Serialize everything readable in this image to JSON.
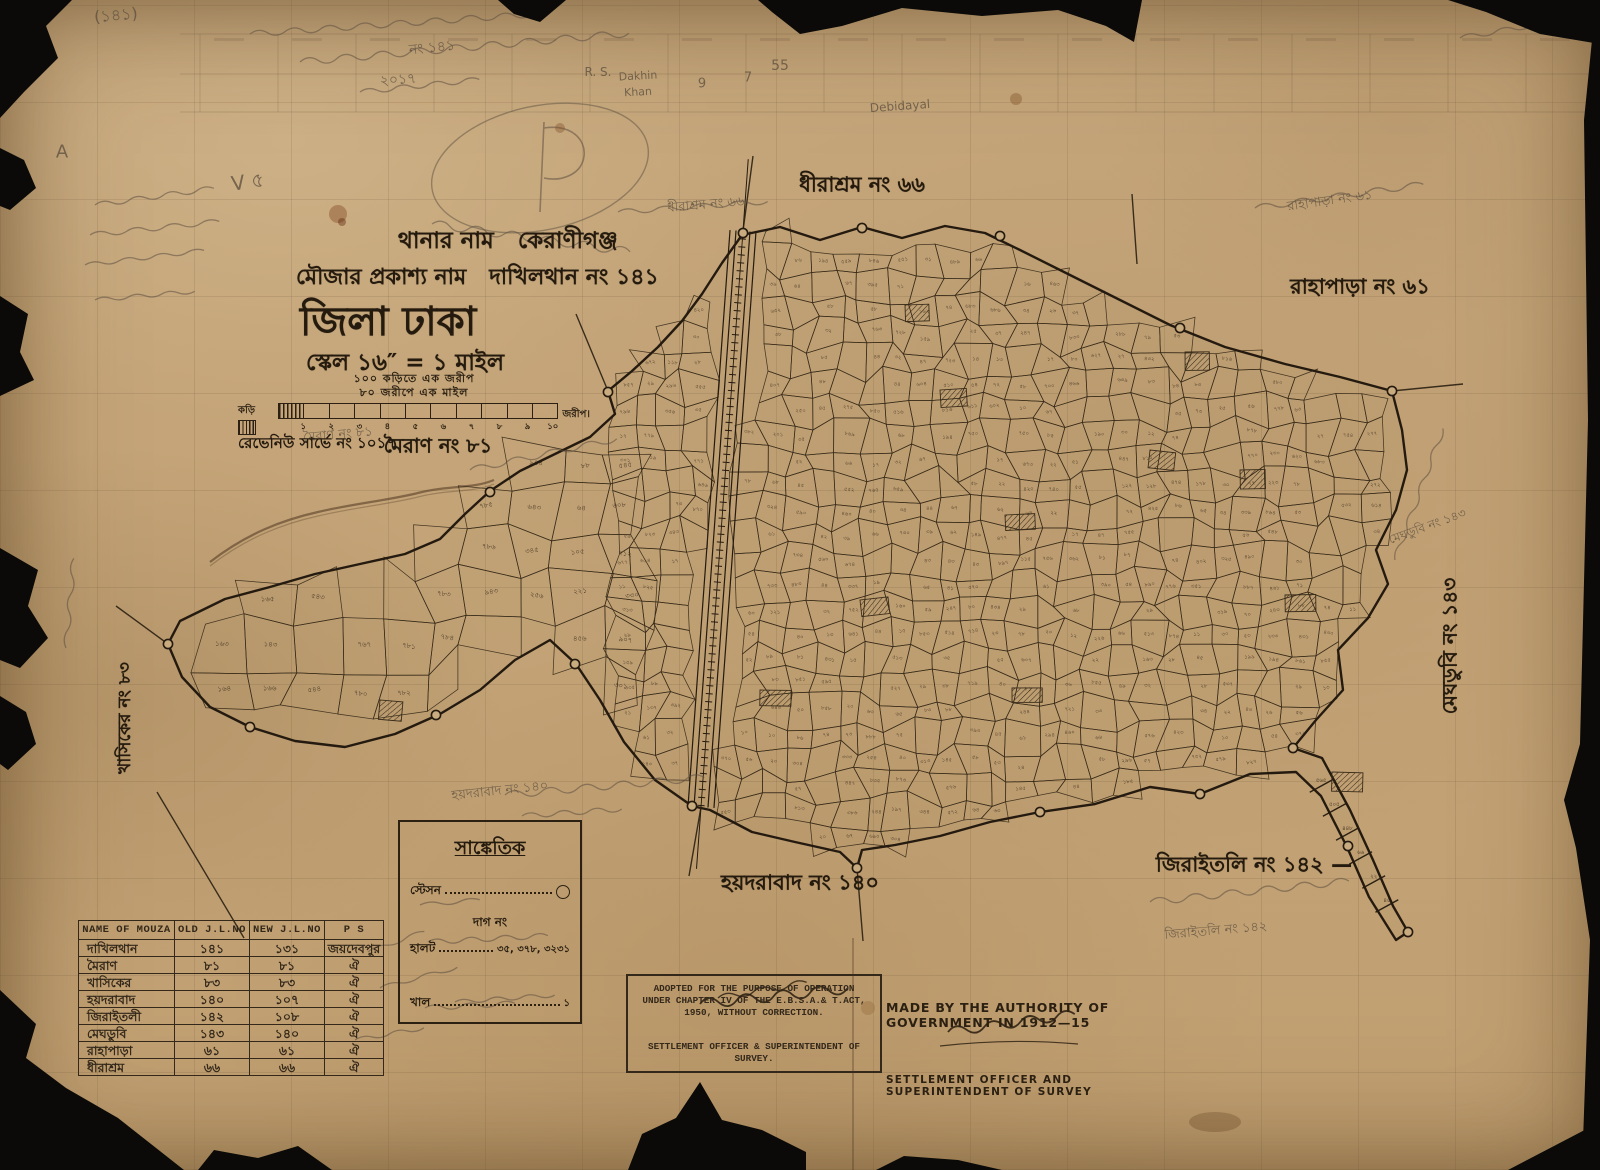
{
  "colors": {
    "paper": "#c6a77c",
    "ink": "#2b2012",
    "pencil": "#6e6051",
    "torn_edge": "#0b0a08",
    "table_ink": "#33281a"
  },
  "title_block": {
    "line1_label": "থানার নাম",
    "line1_value": "কেরাণীগঞ্জ",
    "line2_label": "মৌজার প্রকাশ্য নাম",
    "line2_value": "দাখিলথান নং ১৪১",
    "district": "জিলা ঢাকা",
    "scale_line": "স্কেল ১৬″ = ১ মাইল"
  },
  "scale_bar": {
    "caption1": "১০০ কড়িতে এক জরীপ",
    "caption2": "৮০ জরীপে এক মাইল",
    "left_label": "কড়ি",
    "right_label": "জরীপ।",
    "ticks": [
      "১",
      "২",
      "৩",
      "৪",
      "৫",
      "৬",
      "৭",
      "৮",
      "৯",
      "১০"
    ],
    "revenue": "রেভেনিউ সার্ভে নং ১০১৭"
  },
  "legend": {
    "title": "সাঙ্কেতিক",
    "station_label": "স্টেসন",
    "dag_label": "দাগ নং",
    "halot_label": "হালট",
    "halot_value": "৩৫, ৩৭৮, ৩২৩১",
    "khal_label": "খাল",
    "khal_value": "১"
  },
  "table": {
    "headers": [
      "NAME OF MOUZA",
      "OLD J.L.NO",
      "NEW J.L.NO",
      "P S"
    ],
    "rows": [
      [
        "দাখিলথান",
        "১৪১",
        "১৩১",
        "জয়দেবপুর"
      ],
      [
        "মৈরাণ",
        "৮১",
        "৮১",
        "ঐ"
      ],
      [
        "খাসিকের",
        "৮৩",
        "৮৩",
        "ঐ"
      ],
      [
        "হয়দরাবাদ",
        "১৪০",
        "১০৭",
        "ঐ"
      ],
      [
        "জিরাইতলী",
        "১৪২",
        "১০৮",
        "ঐ"
      ],
      [
        "মেঘডুবি",
        "১৪৩",
        "১৪০",
        "ঐ"
      ],
      [
        "রাহাপাড়া",
        "৬১",
        "৬১",
        "ঐ"
      ],
      [
        "ধীরাশ্রম",
        "৬৬",
        "৬৬",
        "ঐ"
      ]
    ]
  },
  "stamp": {
    "line1": "ADOPTED FOR THE PURPOSE OF OPERATION",
    "line2": "UNDER CHAPTER IV OF THE E.B.S.A.& T.ACT,",
    "line3": "1950, WITHOUT CORRECTION.",
    "signature": "K. A. Khan",
    "line4": "SETTLEMENT OFFICER & SUPERINTENDENT OF",
    "line5": "SURVEY."
  },
  "authority": {
    "line1": "MADE BY THE AUTHORITY OF GOVERNMENT IN 1912—15",
    "signature": "F. D. Ascoli",
    "line2": "SETTLEMENT OFFICER AND SUPERINTENDENT OF SURVEY"
  },
  "mouza_labels": [
    {
      "text": "ধীরাশ্রম নং ৬৬",
      "x": 862,
      "y": 186,
      "size": 21,
      "rot": 0
    },
    {
      "text": "রাহাপাড়া নং ৬১",
      "x": 1360,
      "y": 288,
      "size": 21,
      "rot": 0
    },
    {
      "text": "মেঘডুবি নং ১৪৩",
      "x": 1452,
      "y": 646,
      "size": 20,
      "rot": -90
    },
    {
      "text": "জিরাইতলি নং ১৪২ —",
      "x": 1254,
      "y": 866,
      "size": 21,
      "rot": 0
    },
    {
      "text": "হয়দরাবাদ নং ১৪০",
      "x": 800,
      "y": 884,
      "size": 21,
      "rot": 0
    },
    {
      "text": "মৈরাণ নং ৮১",
      "x": 438,
      "y": 448,
      "size": 20,
      "rot": 0
    },
    {
      "text": "খাসিকের নং ৮৩",
      "x": 126,
      "y": 718,
      "size": 17,
      "rot": -90
    }
  ],
  "pencil_notes": [
    {
      "text": "(১৪১)",
      "x": 116,
      "y": 16,
      "size": 16,
      "rot": -5
    },
    {
      "text": "নং ১৪১",
      "x": 432,
      "y": 48,
      "size": 14,
      "rot": -6
    },
    {
      "text": "২০১৭",
      "x": 398,
      "y": 80,
      "size": 14,
      "rot": -4
    },
    {
      "text": "A",
      "x": 62,
      "y": 152,
      "size": 18,
      "rot": 0
    },
    {
      "text": "V ৫",
      "x": 248,
      "y": 184,
      "size": 20,
      "rot": -8
    },
    {
      "text": "R. S.",
      "x": 598,
      "y": 72,
      "size": 12,
      "rot": 0
    },
    {
      "text": "Dakhin",
      "x": 638,
      "y": 76,
      "size": 11,
      "rot": -3
    },
    {
      "text": "Khan",
      "x": 638,
      "y": 92,
      "size": 11,
      "rot": -3
    },
    {
      "text": "9",
      "x": 702,
      "y": 84,
      "size": 13,
      "rot": 0
    },
    {
      "text": "7",
      "x": 748,
      "y": 78,
      "size": 13,
      "rot": 0
    },
    {
      "text": "55",
      "x": 780,
      "y": 66,
      "size": 14,
      "rot": 0
    },
    {
      "text": "Debidayal",
      "x": 900,
      "y": 106,
      "size": 12,
      "rot": -4
    },
    {
      "text": "ধীরাশ্রম নং ৬৬",
      "x": 706,
      "y": 206,
      "size": 13,
      "rot": -5
    },
    {
      "text": "রাহাপাড়া নং ৬১",
      "x": 1330,
      "y": 202,
      "size": 13,
      "rot": -8
    },
    {
      "text": "মেঘডুবি নং ১৪৩",
      "x": 1428,
      "y": 528,
      "size": 12,
      "rot": -20
    },
    {
      "text": "মৈরাণ নং ৮১",
      "x": 338,
      "y": 436,
      "size": 13,
      "rot": -5
    },
    {
      "text": "হয়দরাবাদ নং ১৪০",
      "x": 500,
      "y": 792,
      "size": 13,
      "rot": -6
    },
    {
      "text": "জিরাইতলি নং ১৪২",
      "x": 1216,
      "y": 932,
      "size": 13,
      "rot": -5
    }
  ],
  "plot_number_samples": [
    "১৬৩",
    "১৬৪",
    "১৬৫",
    "১৪৩",
    "১৬৬",
    "৫৪৩",
    "৫৪৪",
    "৭৬৭",
    "৭৮০",
    "৭৮১",
    "৭৮২",
    "৭৮৩",
    "৭৮৪",
    "৭৮৫",
    "৭৮৬",
    "৯৪৩",
    "৯৪৪",
    "৬৪৩",
    "৩৪৫",
    "২৫৬",
    "৮৮",
    "৬৪",
    "১০৫",
    "২২১",
    "৪৫৬",
    "৫৪৫",
    "৬০৮",
    "৭১২",
    "৩৩০",
    "৯০৭"
  ],
  "map": {
    "boundary": [
      [
        742,
        235
      ],
      [
        780,
        227
      ],
      [
        820,
        240
      ],
      [
        862,
        227
      ],
      [
        902,
        238
      ],
      [
        945,
        226
      ],
      [
        985,
        233
      ],
      [
        1020,
        250
      ],
      [
        1070,
        275
      ],
      [
        1120,
        300
      ],
      [
        1170,
        325
      ],
      [
        1225,
        347
      ],
      [
        1285,
        364
      ],
      [
        1340,
        377
      ],
      [
        1392,
        391
      ],
      [
        1402,
        430
      ],
      [
        1407,
        470
      ],
      [
        1396,
        510
      ],
      [
        1376,
        550
      ],
      [
        1388,
        584
      ],
      [
        1368,
        618
      ],
      [
        1338,
        650
      ],
      [
        1343,
        690
      ],
      [
        1316,
        720
      ],
      [
        1293,
        748
      ],
      [
        1322,
        758
      ],
      [
        1350,
        810
      ],
      [
        1373,
        860
      ],
      [
        1393,
        906
      ],
      [
        1408,
        932
      ],
      [
        1396,
        940
      ],
      [
        1369,
        897
      ],
      [
        1347,
        847
      ],
      [
        1321,
        796
      ],
      [
        1296,
        772
      ],
      [
        1250,
        774
      ],
      [
        1200,
        794
      ],
      [
        1150,
        787
      ],
      [
        1095,
        804
      ],
      [
        1040,
        812
      ],
      [
        990,
        822
      ],
      [
        940,
        836
      ],
      [
        895,
        845
      ],
      [
        862,
        850
      ],
      [
        857,
        868
      ],
      [
        840,
        852
      ],
      [
        795,
        842
      ],
      [
        752,
        832
      ],
      [
        710,
        810
      ],
      [
        692,
        806
      ],
      [
        655,
        780
      ],
      [
        624,
        742
      ],
      [
        600,
        700
      ],
      [
        576,
        664
      ],
      [
        550,
        640
      ],
      [
        515,
        660
      ],
      [
        480,
        690
      ],
      [
        440,
        714
      ],
      [
        395,
        734
      ],
      [
        345,
        747
      ],
      [
        295,
        741
      ],
      [
        250,
        727
      ],
      [
        210,
        707
      ],
      [
        182,
        677
      ],
      [
        168,
        644
      ],
      [
        180,
        621
      ],
      [
        225,
        599
      ],
      [
        270,
        587
      ],
      [
        315,
        574
      ],
      [
        360,
        564
      ],
      [
        405,
        554
      ],
      [
        440,
        539
      ],
      [
        465,
        514
      ],
      [
        490,
        491
      ],
      [
        520,
        471
      ],
      [
        555,
        454
      ],
      [
        590,
        437
      ],
      [
        615,
        414
      ],
      [
        608,
        391
      ],
      [
        632,
        371
      ],
      [
        658,
        347
      ],
      [
        682,
        321
      ],
      [
        702,
        294
      ],
      [
        722,
        263
      ]
    ],
    "railway": {
      "x1": 743,
      "y1": 231,
      "x2": 701,
      "y2": 807
    },
    "stations": [
      [
        743,
        233
      ],
      [
        608,
        392
      ],
      [
        490,
        492
      ],
      [
        168,
        644
      ],
      [
        250,
        727
      ],
      [
        436,
        715
      ],
      [
        575,
        664
      ],
      [
        692,
        806
      ],
      [
        857,
        868
      ],
      [
        1040,
        812
      ],
      [
        1200,
        794
      ],
      [
        1293,
        748
      ],
      [
        1348,
        846
      ],
      [
        1408,
        932
      ],
      [
        1392,
        391
      ],
      [
        1180,
        328
      ],
      [
        1000,
        236
      ],
      [
        862,
        228
      ]
    ],
    "ties": [
      [
        [
          1132,
          194
        ],
        [
          1137,
          264
        ]
      ],
      [
        [
          608,
          391
        ],
        [
          576,
          314
        ]
      ],
      [
        [
          1392,
          391
        ],
        [
          1463,
          384
        ]
      ],
      [
        [
          157,
          792
        ],
        [
          244,
          938
        ]
      ],
      [
        [
          168,
          644
        ],
        [
          116,
          606
        ]
      ],
      [
        [
          857,
          868
        ],
        [
          863,
          941
        ]
      ],
      [
        [
          743,
          231
        ],
        [
          753,
          156
        ]
      ],
      [
        [
          701,
          807
        ],
        [
          689,
          876
        ]
      ]
    ],
    "river": "M210,562 C246,534 282,520 318,512 C356,503 392,500 422,492 C452,485 472,489 494,480",
    "hatches": [
      [
        940,
        390
      ],
      [
        1150,
        450
      ],
      [
        1285,
        595
      ],
      [
        1005,
        515
      ],
      [
        860,
        600
      ],
      [
        760,
        690
      ],
      [
        1012,
        688
      ],
      [
        1185,
        352
      ],
      [
        380,
        700
      ],
      [
        1332,
        772
      ],
      [
        905,
        305
      ],
      [
        1240,
        470
      ]
    ],
    "tail": {
      "from": [
        1308,
        762
      ],
      "to": [
        1400,
        930
      ],
      "rungs": 6,
      "halfw": 13
    },
    "meshes": [
      {
        "x0": 160,
        "y0": 440,
        "x1": 628,
        "y1": 756,
        "step": 44,
        "seed": 7,
        "labelProb": 0.85,
        "font": 7
      },
      {
        "x0": 612,
        "y0": 224,
        "x1": 1418,
        "y1": 868,
        "step": 25,
        "seed": 3,
        "labelProb": 0.7,
        "font": 5.3
      }
    ]
  }
}
